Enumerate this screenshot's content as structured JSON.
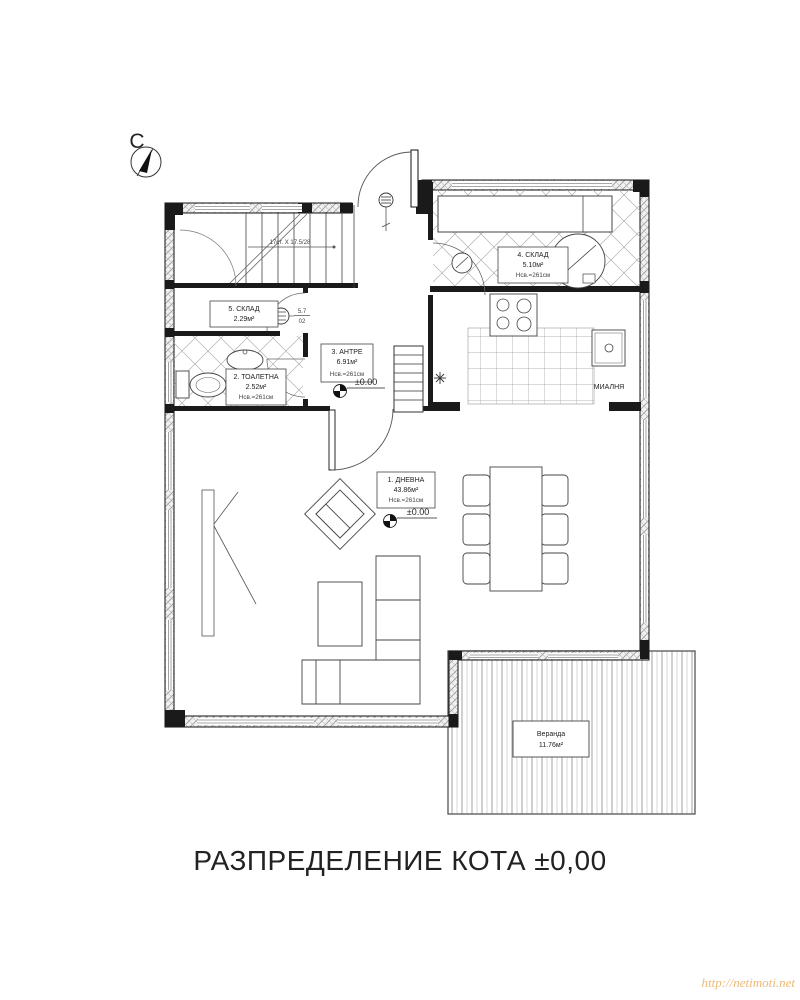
{
  "title": "РАЗПРЕДЕЛЕНИЕ КОТА ±0,00",
  "watermark": "http://netimoti.net",
  "compass": {
    "north_label": "С"
  },
  "stairs": {
    "note": "17ст. X 17.5/28"
  },
  "door_tag": {
    "numerator": "5.7",
    "denominator": "02"
  },
  "levels": {
    "entry": "±0.00",
    "living": "±0.00"
  },
  "rooms": {
    "living": {
      "name": "1. ДНЕВНА",
      "area": "43.86м²",
      "height": "Нсв.=261см"
    },
    "toilet": {
      "name": "2. ТОАЛЕТНА",
      "area": "2.52м²",
      "height": "Нсв.=261см"
    },
    "entry": {
      "name": "3. АНТРЕ",
      "area": "6.91м²",
      "height": "Нсв.=261см"
    },
    "storage4": {
      "name": "4. СКЛАД",
      "area": "5.10м²",
      "height": "Нсв.=261см"
    },
    "storage5": {
      "name": "5. СКЛАД",
      "area": "2.29м²"
    },
    "veranda": {
      "name": "Веранда",
      "area": "11.76м²"
    },
    "scullery": {
      "name": "МИАЛНЯ"
    }
  }
}
